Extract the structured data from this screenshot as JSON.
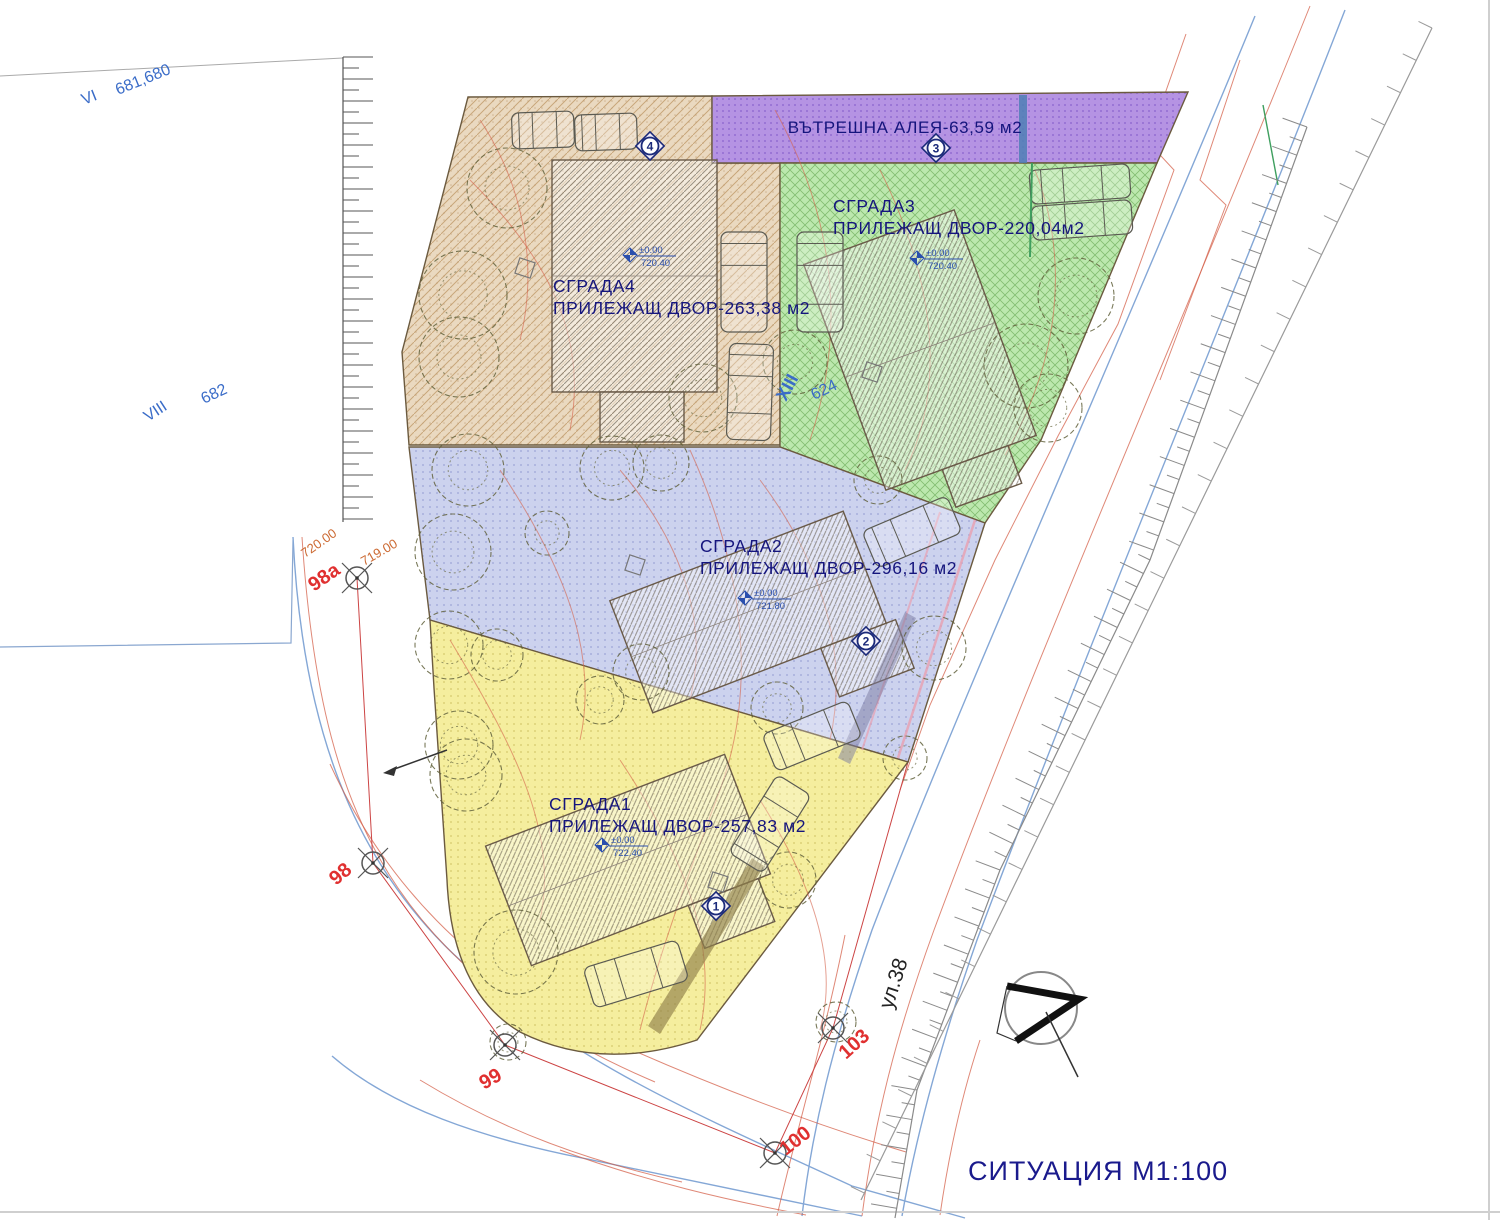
{
  "title": "СИТУАЦИЯ М1:100",
  "alley": {
    "label": "ВЪТРЕШНА АЛЕЯ-63,59 м2",
    "color": "#b593e3"
  },
  "zones": [
    {
      "name": "СГРАДА1",
      "yard": "ПРИЛЕЖАЩ ДВОР-257,83 м2",
      "color": "#f5ee9e",
      "elev_top": "±0.00",
      "elev_base": "722.40"
    },
    {
      "name": "СГРАДА2",
      "yard": "ПРИЛЕЖАЩ ДВОР-296,16 м2",
      "color": "#ccd2ee",
      "elev_top": "±0.00",
      "elev_base": "721.80"
    },
    {
      "name": "СГРАДА3",
      "yard": "ПРИЛЕЖАЩ ДВОР-220,04м2",
      "color": "#bce8ae",
      "elev_top": "±0.00",
      "elev_base": "720.40"
    },
    {
      "name": "СГРАДА4",
      "yard": "ПРИЛЕЖАЩ ДВОР-263,38 м2",
      "color": "#ead9c0",
      "elev_top": "±0.00",
      "elev_base": "720.40"
    }
  ],
  "markers": [
    {
      "n": "4"
    },
    {
      "n": "3"
    },
    {
      "n": "2"
    },
    {
      "n": "1"
    }
  ],
  "parcels": [
    {
      "label": "VI"
    },
    {
      "label": "681,680"
    },
    {
      "label": "VIII"
    },
    {
      "label": "682"
    },
    {
      "label": "XIII"
    },
    {
      "label": "624"
    }
  ],
  "survey_points": [
    {
      "label": "98a"
    },
    {
      "label": "98"
    },
    {
      "label": "99"
    },
    {
      "label": "100"
    },
    {
      "label": "103"
    }
  ],
  "contour_labels": [
    {
      "label": "720.00"
    },
    {
      "label": "719.00"
    }
  ],
  "street": {
    "label": "ул.38"
  },
  "colors": {
    "label_navy": "#15157d",
    "parcel_blue": "#3a6cc8",
    "point_red": "#e03030",
    "contour_orange": "#cc6a33",
    "title_navy": "#1a1a8c",
    "elev_blue": "#2a4fae"
  }
}
